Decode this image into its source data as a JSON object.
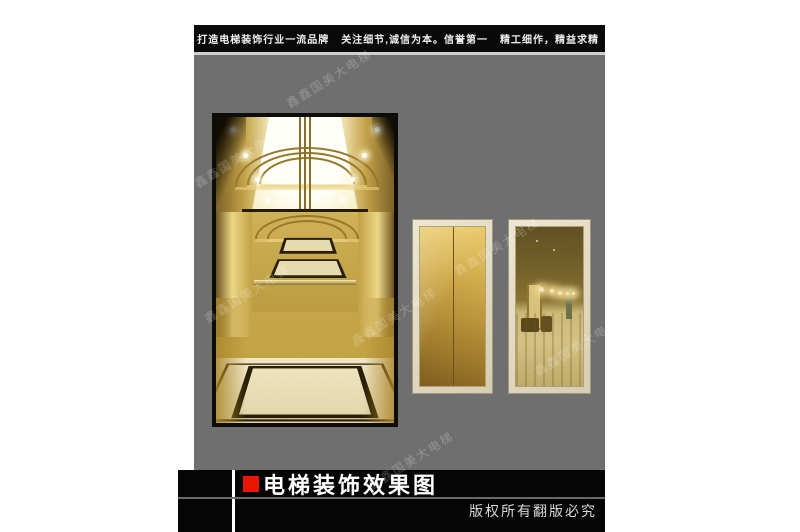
{
  "colors": {
    "accent_red": "#e81500",
    "canvas_gray": "#6f6f6f",
    "bar_black": "#0a0a0a",
    "gold": "#c9a43f",
    "door_frame_cream": "#d9d2bc"
  },
  "header": {
    "slogan1": "打造电梯装饰行业一流品牌",
    "slogan2": "关注细节,诚信为本。信誉第一",
    "slogan3": "精工细作，精益求精"
  },
  "footer": {
    "title": "电梯装饰效果图",
    "copyright": "版权所有翻版必究"
  },
  "watermark": {
    "text": "鑫鑫国美大电梯"
  }
}
